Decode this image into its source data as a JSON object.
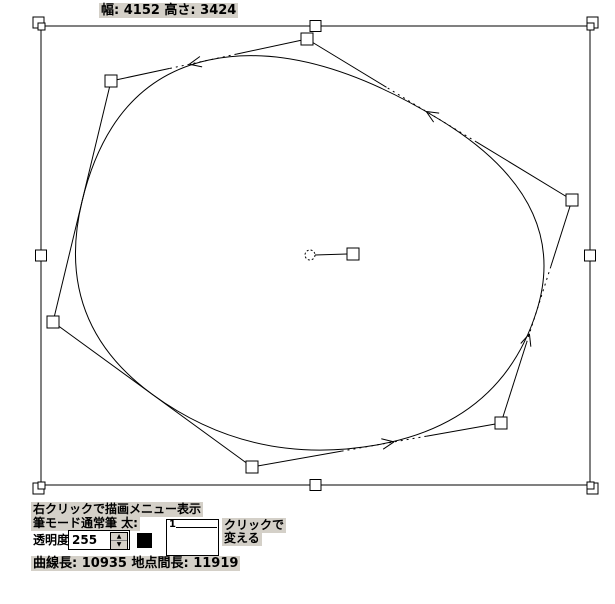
{
  "colors": {
    "label_bg": "#d4d0c8",
    "stroke": "#000000",
    "canvas_bg": "#ffffff",
    "swatch_color": "#000000"
  },
  "header": {
    "size_label": "幅: 4152  高さ: 3424"
  },
  "canvas": {
    "bbox": {
      "x1": 41,
      "y1": 26,
      "x2": 590,
      "y2": 485
    },
    "control_points": [
      [
        307,
        39
      ],
      [
        111,
        81
      ],
      [
        53,
        322
      ],
      [
        252,
        467
      ],
      [
        501,
        423
      ],
      [
        572,
        200
      ]
    ],
    "control_point_size": 12,
    "handle_size": 11,
    "corner_inner_size": 7,
    "dotted_segments": [
      0,
      3,
      4,
      5
    ],
    "arrows": [
      {
        "segment": 0,
        "t": 0.6
      },
      {
        "segment": 3,
        "t": 0.57
      },
      {
        "segment": 4,
        "t": 0.4
      },
      {
        "segment": 5,
        "t": 0.55
      }
    ],
    "center_marker": {
      "circle": [
        310,
        255
      ],
      "radius": 5,
      "square": [
        347,
        248
      ],
      "square_size": 12
    }
  },
  "toolbar": {
    "context_hint": "右クリックで描画メニュー表示",
    "brush_mode_label": "筆モード通常筆 太:",
    "opacity_label": "透明度:",
    "opacity_value": "255",
    "spinner_up_icon": "▲",
    "spinner_down_icon": "▼",
    "thickness_value": "1",
    "click_hint_line1": "クリックで",
    "click_hint_line2": "変える",
    "status_label": "曲線長: 10935 地点間長: 11919"
  }
}
